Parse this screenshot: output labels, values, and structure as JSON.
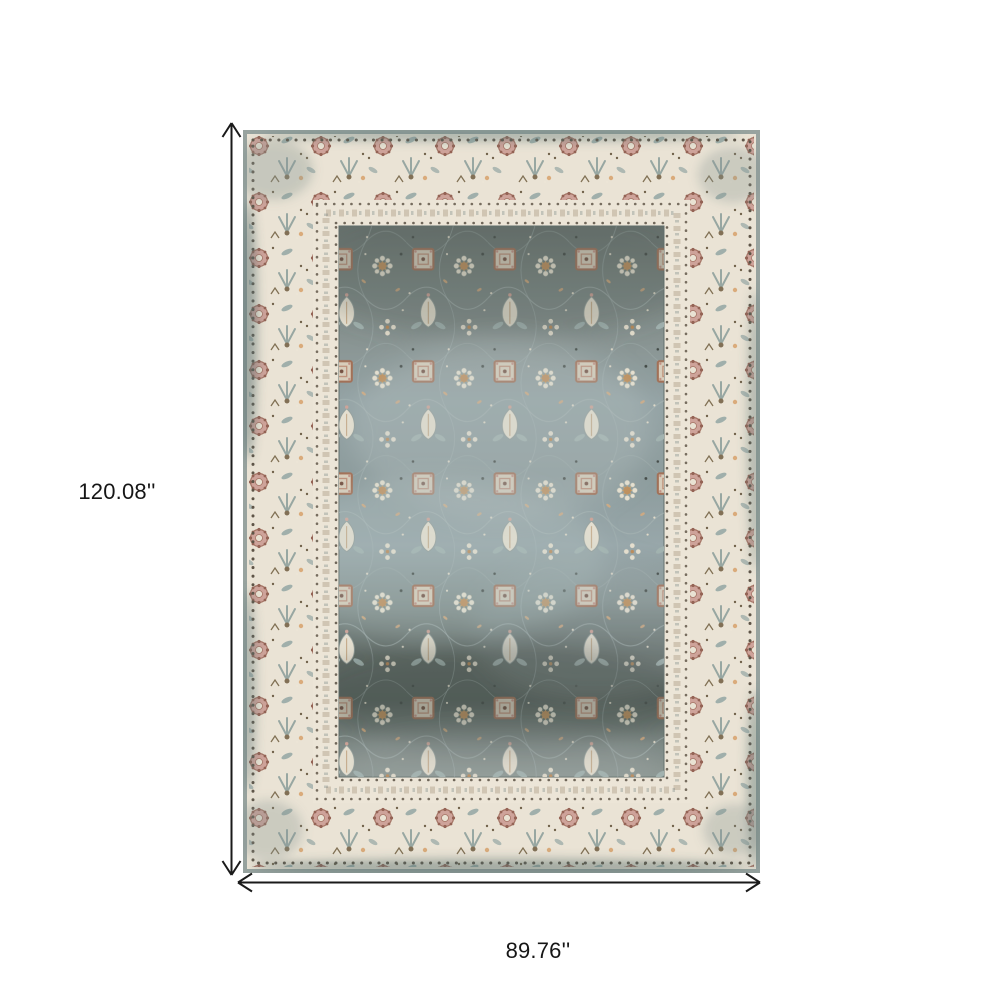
{
  "diagram": {
    "height_label": "120.08''",
    "width_label": "89.76''",
    "arrow_color": "#1a1a1a",
    "background": "#ffffff"
  },
  "rug": {
    "alt": "distressed vintage oriental area rug, ivory floral border with slate blue-gray floral field",
    "colors": {
      "border_cream": "#eae4d5",
      "field_slate": "#7d8c8a",
      "field_dark_band": "#4e5a55",
      "field_light_band": "#93a4a7",
      "edge_teal": "#7e908c",
      "accent_rust": "#9e6a4f",
      "accent_mauve": "#cda096",
      "accent_tan": "#bd8a52",
      "accent_blue_gray": "#9cada8",
      "motif_ivory": "#e8e2d0",
      "guard_dot_brown": "#584e3f"
    }
  }
}
